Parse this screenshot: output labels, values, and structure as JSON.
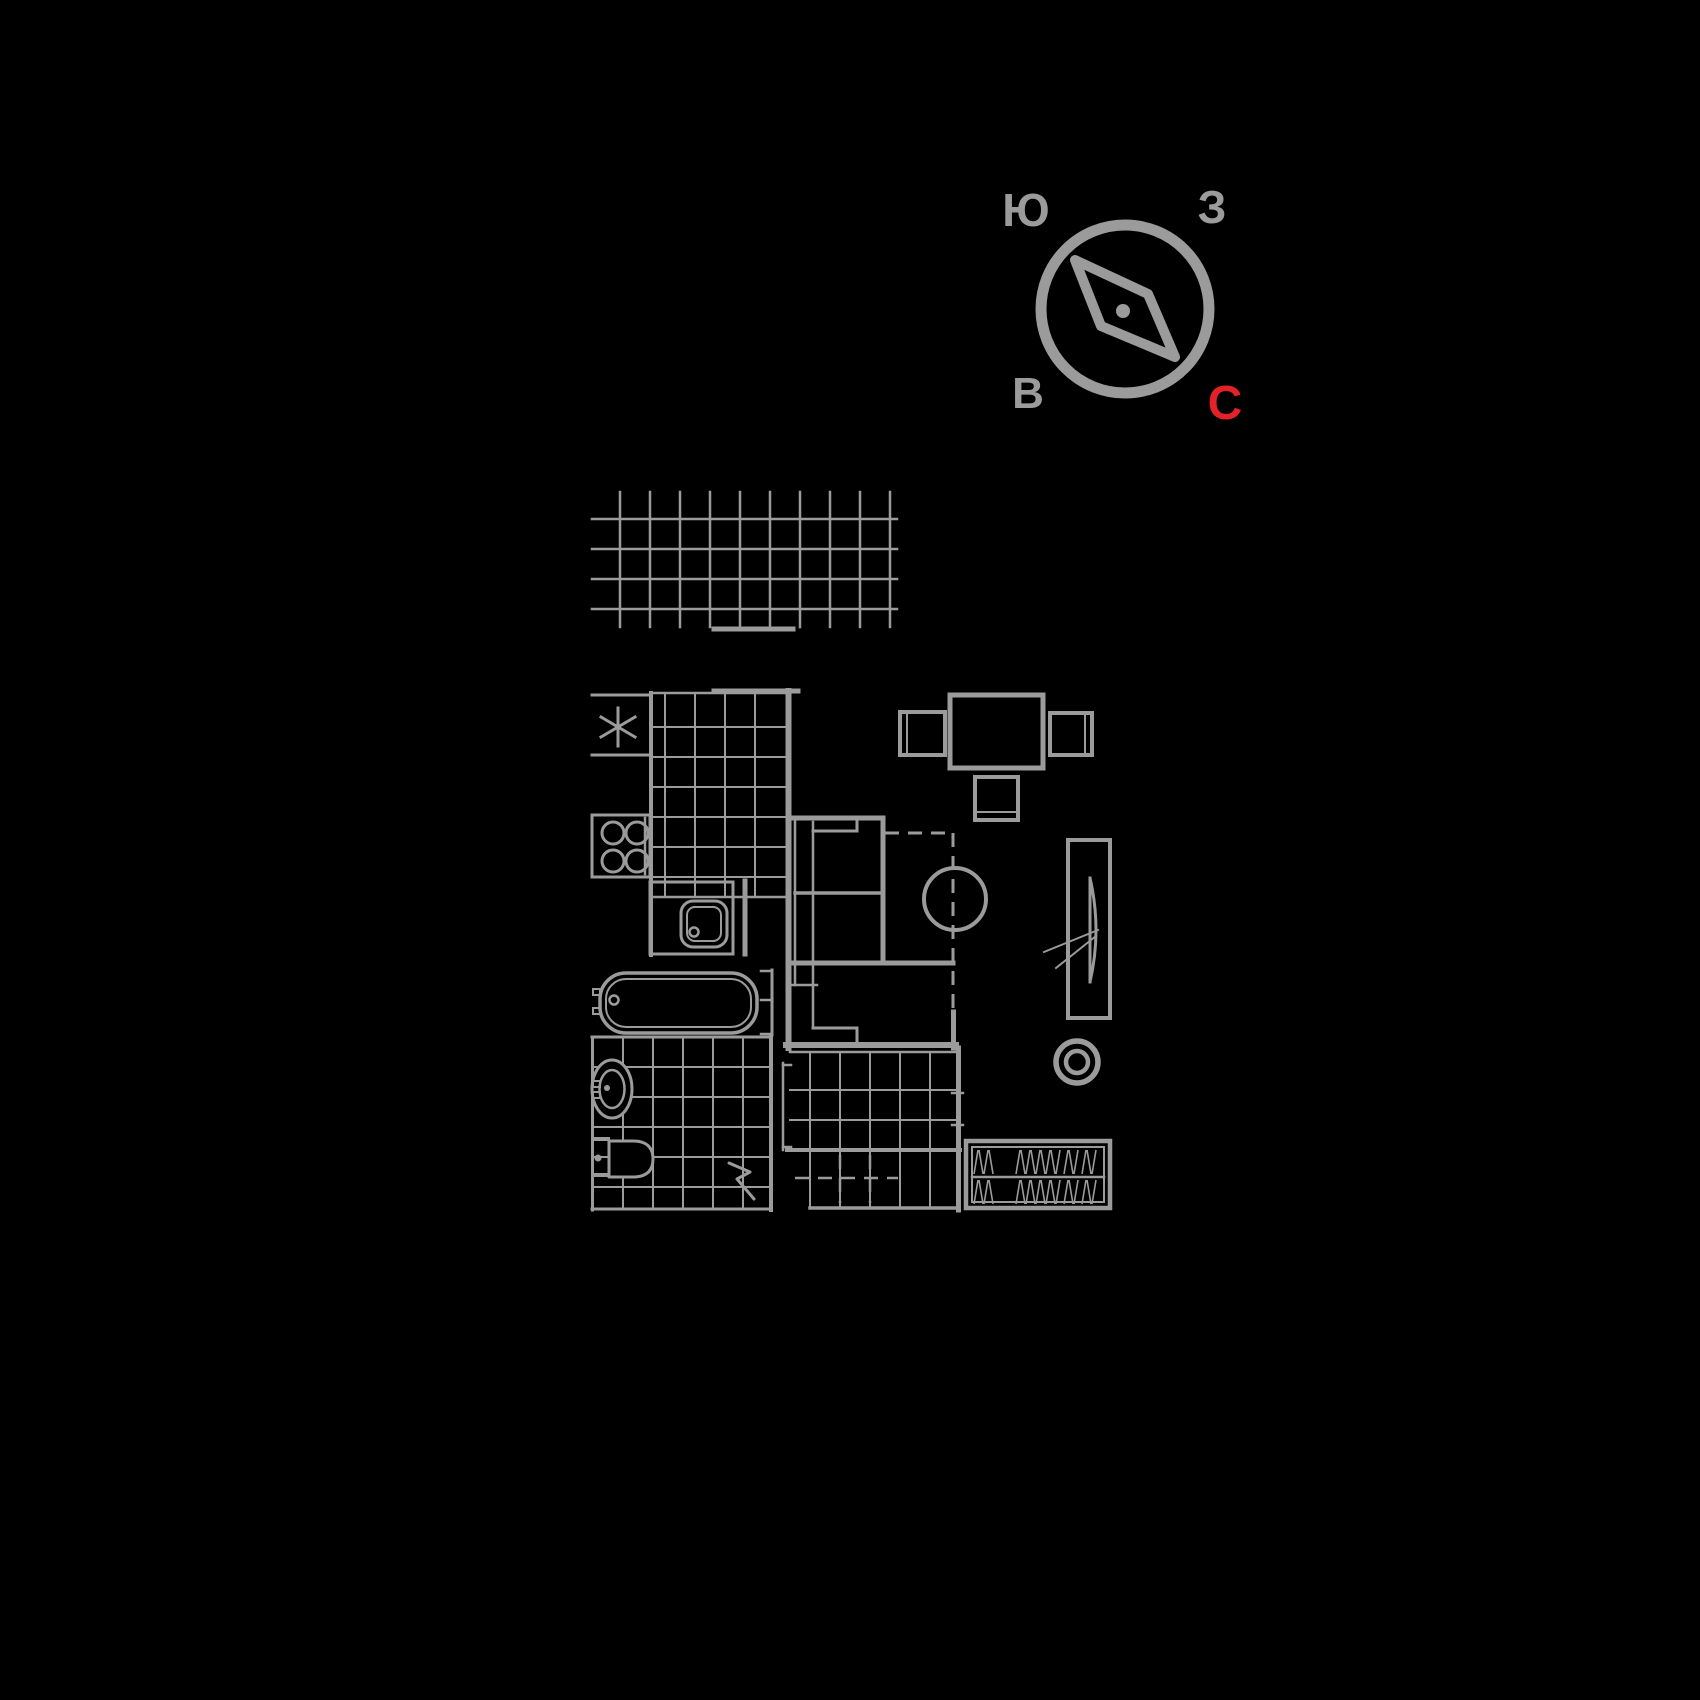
{
  "canvas": {
    "width": 1700,
    "height": 1700,
    "background": "#000000",
    "line_color": "#9b9b9b",
    "fill_color": "#000000",
    "accent_red": "#e32128"
  },
  "compass": {
    "labels": {
      "south": "Ю",
      "west": "З",
      "east": "В",
      "north": "С"
    },
    "north_is_accent": true,
    "geometry": {
      "center_x": 1125,
      "center_y": 309,
      "radius": 84,
      "ring_width": 11,
      "needle_points": "1075,260 1148,294 1175,357 1101,326",
      "needle_width": 10,
      "dot_x": 1123,
      "dot_y": 311,
      "dot_r": 7,
      "label_positions": {
        "south": {
          "x": 1026,
          "y": 226,
          "size": 46
        },
        "west": {
          "x": 1212,
          "y": 223,
          "size": 46
        },
        "east": {
          "x": 1028,
          "y": 408,
          "size": 44
        },
        "north": {
          "x": 1225,
          "y": 419,
          "size": 48
        }
      }
    }
  },
  "floor_plan": {
    "features": [
      {
        "name": "loggia-tile-grid",
        "shapes": [
          [
            "gv",
            [
              620,
              650,
              680,
              710,
              740,
              770,
              800,
              830,
              860,
              890
            ],
            492,
            627,
            2.5
          ],
          [
            "gh",
            [
              519,
              549,
              579,
              609
            ],
            592,
            897,
            2.5
          ],
          [
            "l",
            714,
            629,
            793,
            629,
            5
          ]
        ]
      },
      {
        "name": "kitchen-walls",
        "shapes": [
          [
            "l",
            592,
            695,
            651,
            695,
            3
          ],
          [
            "l",
            592,
            755,
            651,
            755,
            3
          ],
          [
            "l",
            651,
            693,
            651,
            955,
            4
          ],
          [
            "l",
            714,
            691,
            798,
            691,
            5
          ],
          [
            "l",
            745,
            881,
            745,
            954,
            5
          ]
        ]
      },
      {
        "name": "vent-asterisk",
        "shapes": [
          [
            "l",
            618,
            708,
            618,
            746,
            3
          ],
          [
            "l",
            601,
            717,
            635,
            737,
            3
          ],
          [
            "l",
            601,
            737,
            635,
            717,
            3
          ]
        ]
      },
      {
        "name": "kitchen-tile-grid",
        "shapes": [
          [
            "l",
            653,
            693,
            787,
            693,
            2.5
          ],
          [
            "gv",
            [
              665,
              695,
              725,
              755
            ],
            693,
            897,
            2
          ],
          [
            "gh",
            [
              727,
              757,
              787,
              817,
              847,
              877
            ],
            653,
            787,
            2
          ],
          [
            "l",
            651,
            897,
            787,
            897,
            2.5
          ]
        ]
      },
      {
        "name": "stove",
        "shapes": [
          [
            "r",
            592,
            815,
            58,
            62,
            3
          ],
          [
            "l",
            645,
            818,
            645,
            874,
            2.5
          ],
          [
            "c",
            613,
            833,
            11,
            3
          ],
          [
            "c",
            637,
            833,
            11,
            3
          ],
          [
            "c",
            613,
            861,
            11,
            3
          ],
          [
            "c",
            637,
            861,
            11,
            3
          ]
        ]
      },
      {
        "name": "kitchen-sink",
        "shapes": [
          [
            "r",
            650,
            882,
            83,
            72,
            3
          ],
          [
            "rr",
            681,
            901,
            46,
            46,
            12,
            3
          ],
          [
            "rr",
            687,
            907,
            34,
            34,
            8,
            2
          ],
          [
            "c",
            694,
            932,
            4.5,
            2.5
          ]
        ]
      },
      {
        "name": "dining-set",
        "shapes": [
          [
            "r",
            950,
            695,
            93,
            73,
            5
          ],
          [
            "r",
            900,
            712,
            45,
            43,
            4
          ],
          [
            "l",
            907,
            714,
            907,
            753,
            2
          ],
          [
            "r",
            1050,
            713,
            42,
            42,
            4
          ],
          [
            "l",
            1085,
            715,
            1085,
            753,
            2
          ],
          [
            "r",
            975,
            777,
            43,
            43,
            4
          ],
          [
            "l",
            977,
            812,
            1016,
            812,
            2
          ]
        ]
      },
      {
        "name": "sofa-bed",
        "shapes": [
          [
            "l",
            788,
            818,
            883,
            818,
            5
          ],
          [
            "l",
            883,
            818,
            883,
            963,
            5
          ],
          [
            "l",
            788,
            963,
            953,
            963,
            5
          ],
          [
            "l",
            790,
            820,
            790,
            961,
            3
          ],
          [
            "l",
            795,
            820,
            795,
            985,
            2.5
          ],
          [
            "l",
            813,
            822,
            813,
            1028,
            2.5
          ],
          [
            "l",
            795,
            893,
            883,
            893,
            3.5
          ],
          [
            "l",
            813,
            831,
            857,
            831,
            3
          ],
          [
            "l",
            857,
            818,
            857,
            831,
            3
          ],
          [
            "l",
            790,
            985,
            817,
            985,
            2.5
          ]
        ]
      },
      {
        "name": "zone-divider-dashed",
        "shapes": [
          [
            "d",
            885,
            833,
            951,
            833,
            3
          ],
          [
            "d",
            953,
            833,
            953,
            1043,
            3
          ]
        ]
      },
      {
        "name": "coffee-table",
        "shapes": [
          [
            "c",
            955,
            899,
            31,
            4
          ]
        ]
      },
      {
        "name": "wardrobe",
        "shapes": [
          [
            "r",
            1068,
            840,
            42,
            178,
            4
          ],
          [
            "l",
            1090,
            878,
            1090,
            982,
            3
          ],
          [
            "p",
            "M1090,878 Q1102,930 1090,982",
            3
          ],
          [
            "l",
            1044,
            952,
            1098,
            930,
            2
          ],
          [
            "l",
            1056,
            968,
            1096,
            936,
            2
          ]
        ]
      },
      {
        "name": "stool-ring",
        "shapes": [
          [
            "c",
            1077,
            1062,
            21,
            5.5
          ],
          [
            "c",
            1077,
            1062,
            11,
            4.5
          ]
        ]
      },
      {
        "name": "walls",
        "shapes": [
          [
            "l",
            788.5,
            691,
            788.5,
            1048,
            6
          ],
          [
            "l",
            786,
            1045,
            956,
            1045,
            6
          ],
          [
            "l",
            813,
            1028,
            857,
            1028,
            3
          ],
          [
            "l",
            857,
            1028,
            857,
            1043,
            3
          ],
          [
            "l",
            953.5,
            1012,
            953.5,
            1048,
            5
          ],
          [
            "l",
            958.5,
            1048,
            958.5,
            1210,
            5
          ],
          [
            "l",
            952,
            1093,
            963,
            1093,
            2.5
          ],
          [
            "l",
            952,
            1125,
            963,
            1125,
            2.5
          ],
          [
            "l",
            783,
            1063,
            783,
            1150,
            2.5
          ],
          [
            "l",
            783,
            1065,
            791,
            1065,
            2.5
          ],
          [
            "l",
            783,
            1147,
            791,
            1147,
            2.5
          ],
          [
            "l",
            787,
            1150,
            960,
            1150,
            4
          ]
        ]
      },
      {
        "name": "bathtub",
        "shapes": [
          [
            "rr",
            600,
            973,
            157,
            60,
            26,
            3.5
          ],
          [
            "rr",
            606,
            979,
            145,
            48,
            20,
            2
          ],
          [
            "c",
            614,
            1000,
            4.5,
            2.5
          ],
          [
            "r",
            593,
            989,
            7,
            6,
            2
          ],
          [
            "r",
            593,
            1008,
            7,
            6,
            2
          ],
          [
            "l",
            772,
            970,
            772,
            1035,
            3
          ],
          [
            "l",
            761,
            971,
            772,
            971,
            2.5
          ],
          [
            "l",
            761,
            1000,
            772,
            1000,
            2.5
          ],
          [
            "l",
            761,
            1034,
            772,
            1034,
            2.5
          ]
        ]
      },
      {
        "name": "bathroom-tile-grid",
        "shapes": [
          [
            "l",
            592.5,
            1037,
            592.5,
            1210,
            3
          ],
          [
            "l",
            592,
            1037,
            771,
            1037,
            3
          ],
          [
            "l",
            771,
            1037,
            771,
            1210,
            4
          ],
          [
            "l",
            592,
            1209,
            771,
            1209,
            3
          ],
          [
            "gv",
            [
              623,
              653,
              683,
              713,
              743
            ],
            1037,
            1209,
            2
          ],
          [
            "gh",
            [
              1067,
              1097,
              1127,
              1157,
              1187
            ],
            592,
            771,
            2
          ]
        ]
      },
      {
        "name": "washbasin",
        "shapes": [
          [
            "e",
            612,
            1089,
            20,
            29,
            3
          ],
          [
            "e",
            612,
            1089,
            12.5,
            19,
            2.5
          ],
          [
            "cf",
            607,
            1088,
            3
          ],
          [
            "r",
            593,
            1081,
            7,
            6,
            2
          ],
          [
            "r",
            593,
            1092,
            7,
            6,
            2
          ]
        ]
      },
      {
        "name": "toilet",
        "shapes": [
          [
            "pf",
            "M609,1141 L633,1141 C650,1141 653,1151 653,1159 C653,1167 650,1177 633,1177 L609,1177 Z",
            3
          ],
          [
            "cf",
            598,
            1158,
            3.5
          ],
          [
            "l",
            594,
            1139,
            608,
            1139,
            4
          ],
          [
            "l",
            594,
            1175,
            608,
            1175,
            4
          ]
        ]
      },
      {
        "name": "hallway-tile-grid",
        "shapes": [
          [
            "l",
            790,
            1052,
            958,
            1052,
            2.5
          ],
          [
            "gv",
            [
              810,
              840,
              870,
              900,
              930
            ],
            1052,
            1208,
            2
          ],
          [
            "gh",
            [
              1090,
              1120
            ],
            790,
            958,
            2
          ],
          [
            "l",
            810,
            1208,
            958,
            1208,
            3.5
          ]
        ]
      },
      {
        "name": "entry-door-swing-dashed",
        "shapes": [
          [
            "d",
            795,
            1178,
            898,
            1178,
            2.5
          ],
          [
            "d",
            840,
            1155,
            840,
            1203,
            2.5
          ],
          [
            "d",
            870,
            1155,
            870,
            1203,
            2.5
          ]
        ]
      },
      {
        "name": "entry-door-mark",
        "shapes": [
          [
            "p",
            "M729,1163 L750,1172 L737,1179 L754,1199",
            3
          ]
        ]
      },
      {
        "name": "shoe-cabinet",
        "shapes": [
          [
            "r",
            966,
            1141,
            144,
            67,
            4.5
          ],
          [
            "r",
            972,
            1147,
            132,
            55,
            2
          ],
          [
            "l",
            972,
            1177,
            1104,
            1177,
            2.5
          ],
          [
            "h",
            976,
            994,
            1150,
            1174,
            5
          ],
          [
            "h",
            1018,
            1062,
            1150,
            1174,
            5
          ],
          [
            "h",
            1066,
            1080,
            1150,
            1174,
            5
          ],
          [
            "h",
            1084,
            1098,
            1150,
            1174,
            5
          ],
          [
            "h",
            976,
            994,
            1180,
            1204,
            5
          ],
          [
            "h",
            1018,
            1062,
            1180,
            1204,
            5
          ],
          [
            "h",
            1066,
            1080,
            1180,
            1204,
            5
          ],
          [
            "h",
            1084,
            1098,
            1180,
            1204,
            5
          ]
        ]
      }
    ]
  }
}
